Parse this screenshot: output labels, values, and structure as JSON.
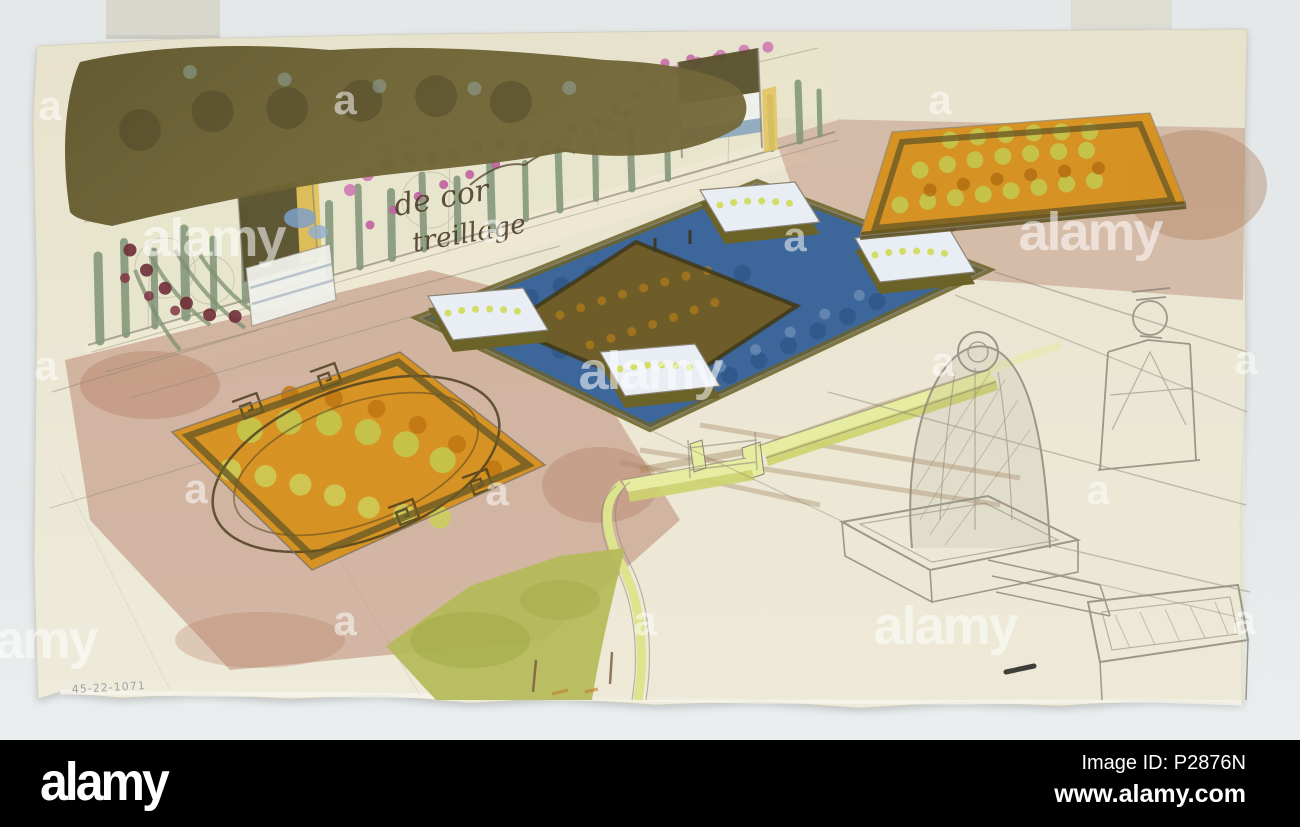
{
  "artwork": {
    "handwriting_line1": "de cor",
    "handwriting_line2": "treillage",
    "corner_inscription": "45-22-1071"
  },
  "watermarks": {
    "letter": "a",
    "word": "alamy",
    "a_positions": [
      [
        345,
        100
      ],
      [
        940,
        100
      ],
      [
        50,
        106
      ],
      [
        493,
        228
      ],
      [
        795,
        237
      ],
      [
        46,
        366
      ],
      [
        943,
        362
      ],
      [
        1246,
        360
      ],
      [
        196,
        489
      ],
      [
        497,
        491
      ],
      [
        1098,
        490
      ],
      [
        345,
        621
      ],
      [
        645,
        621
      ],
      [
        1244,
        620
      ]
    ],
    "word_positions": [
      [
        213,
        238
      ],
      [
        1090,
        232
      ],
      [
        650,
        371
      ],
      [
        945,
        626
      ],
      [
        25,
        640
      ]
    ]
  },
  "footer": {
    "logo": "alamy",
    "image_id": "Image ID: P2876N",
    "website": "www.alamy.com"
  },
  "palette": {
    "bg": "#e5e8e9",
    "bg-light": "#edf0f0",
    "bar": "#000000",
    "paper": "#eae6d2",
    "paper-dark": "#e3deca",
    "tape": "#d6d5cb",
    "water": "#3d679a",
    "water-dark": "#2c5183",
    "water-light": "#7b99c0",
    "orange": "#d6921f",
    "olive-bed": "#6e5d28",
    "olive-hedge": "#6b6227",
    "yellow-green": "#c3c64e",
    "pink-path": "#bc8a77",
    "rose": "#cf7fb4",
    "maroon": "#6f2d38",
    "wall-cream": "#e8e4cc",
    "cypress": "#86987c",
    "tree-dark": "#665c31",
    "lawn": "#b4ba58",
    "graphite": "#8b8477",
    "white-bed": "#e9edf4",
    "parapet": "#e6eca0",
    "handwriting": "#4a3a26",
    "inscription": "#8f96a2"
  }
}
